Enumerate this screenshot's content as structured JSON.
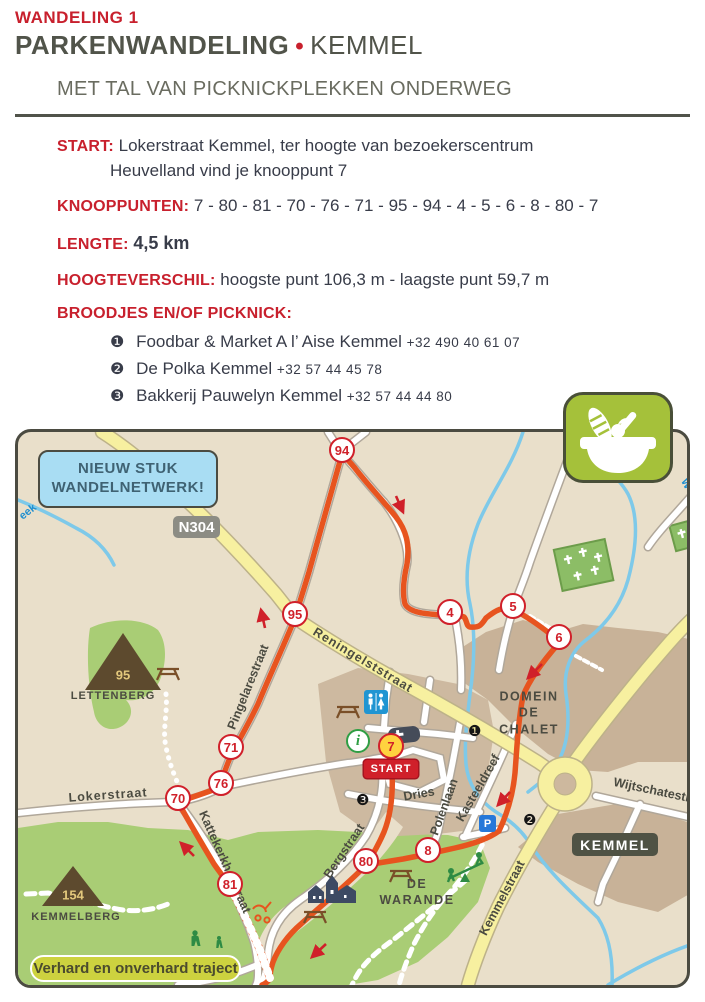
{
  "page": {
    "kicker": "WANDELING 1",
    "title": "PARKENWANDELING",
    "separator": "•",
    "place": "KEMMEL",
    "subtitle": "MET TAL VAN PICKNICKPLEKKEN ONDERWEG"
  },
  "info": {
    "start_label": "START:",
    "start_line1": "Lokerstraat Kemmel, ter hoogte van bezoekerscentrum",
    "start_line2": "Heuvelland vind je knooppunt 7",
    "knooppunten_label": "KNOOPPUNTEN:",
    "knooppunten": "7 - 80 - 81 - 70 - 76 - 71 - 95 - 94 - 4 - 5 - 6 - 8 - 80 - 7",
    "lengte_label": "LENGTE:",
    "lengte": "4,5 km",
    "hoogte_label": "HOOGTEVERSCHIL:",
    "hoogte": "hoogste punt 106,3 m - laagste punt 59,7 m",
    "broodjes_label": "BROODJES EN/OF PICKNICK:",
    "items": [
      {
        "bullet": "❶",
        "name": "Foodbar & Market A l’ Aise Kemmel",
        "phone": "+32 490 40 61 07"
      },
      {
        "bullet": "❷",
        "name": "De Polka Kemmel",
        "phone": "+32 57 44 45 78"
      },
      {
        "bullet": "❸",
        "name": "Bakkerij Pauwelyn Kemmel",
        "phone": "+32 57 44 44 80"
      }
    ]
  },
  "map": {
    "callout_line1": "NIEUW STUK",
    "callout_line2": "WANDELNETWERK!",
    "road_badge": "N304",
    "town_badge": "KEMMEL",
    "legend": "Verhard en onverhard traject",
    "start_flag": "START",
    "nodes": [
      "94",
      "95",
      "4",
      "5",
      "6",
      "71",
      "76",
      "70",
      "81",
      "80",
      "8",
      "7"
    ],
    "hills": [
      {
        "name": "LETTENBERG",
        "height": "95"
      },
      {
        "name": "KEMMELBERG",
        "height": "154"
      }
    ],
    "areas": [
      "DOMEIN\nDE\nCHALET",
      "DE\nWARANDE"
    ],
    "streets": [
      "Reningelststraat",
      "Pingelarestraat",
      "Lokerstraat",
      "Kattekerkhofstraat",
      "Bergstraat",
      "Dries",
      "Polenlaan",
      "Kasteeldreef",
      "Kemmelstraat",
      "Wijtschatestr"
    ],
    "stream_labels": [
      "eek",
      "W"
    ],
    "poi_markers": [
      "❶",
      "❷",
      "❸"
    ],
    "parking_icon": "P",
    "info_icon": "i",
    "colors": {
      "accent_red": "#c8202d",
      "route_orange": "#e7541f",
      "map_bg": "#e9dfca",
      "village_tan": "#cdb9a0",
      "park_green": "#a9cd75",
      "road_yellow": "#f7f0a0",
      "stream_blue": "#7ec9e9",
      "callout_blue": "#a9ddf3",
      "badge_olive": "#4f5244",
      "picnic_icon_green": "#a5c13a"
    }
  }
}
